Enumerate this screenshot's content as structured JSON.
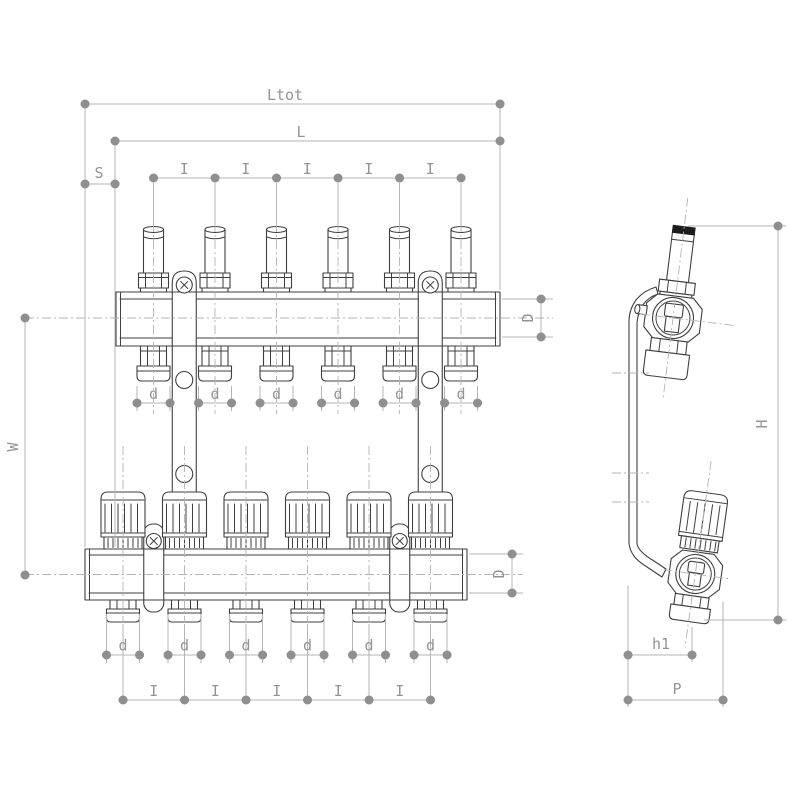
{
  "page": {
    "background": "#ffffff",
    "description": "Technical dimension drawing of a 6-port underfloor-heating manifold set: front view (top manifold with flow meters, bottom manifold with valve knobs) and side view with mounting bracket",
    "ports": 6
  },
  "labels": {
    "total_length": "Ltot",
    "body_length": "L",
    "end_offset": "S",
    "port_spacing": "I",
    "port_diameter": "d",
    "manifold_diameter": "D",
    "axis_distance": "W",
    "overall_height": "H",
    "outlet_height": "h1",
    "depth": "P"
  },
  "colors": {
    "part_line": "#3f3f3f",
    "dim_line": "#b5b5b5",
    "dim_dot": "#8f8f8f",
    "dim_text": "#949494",
    "background": "#ffffff"
  }
}
